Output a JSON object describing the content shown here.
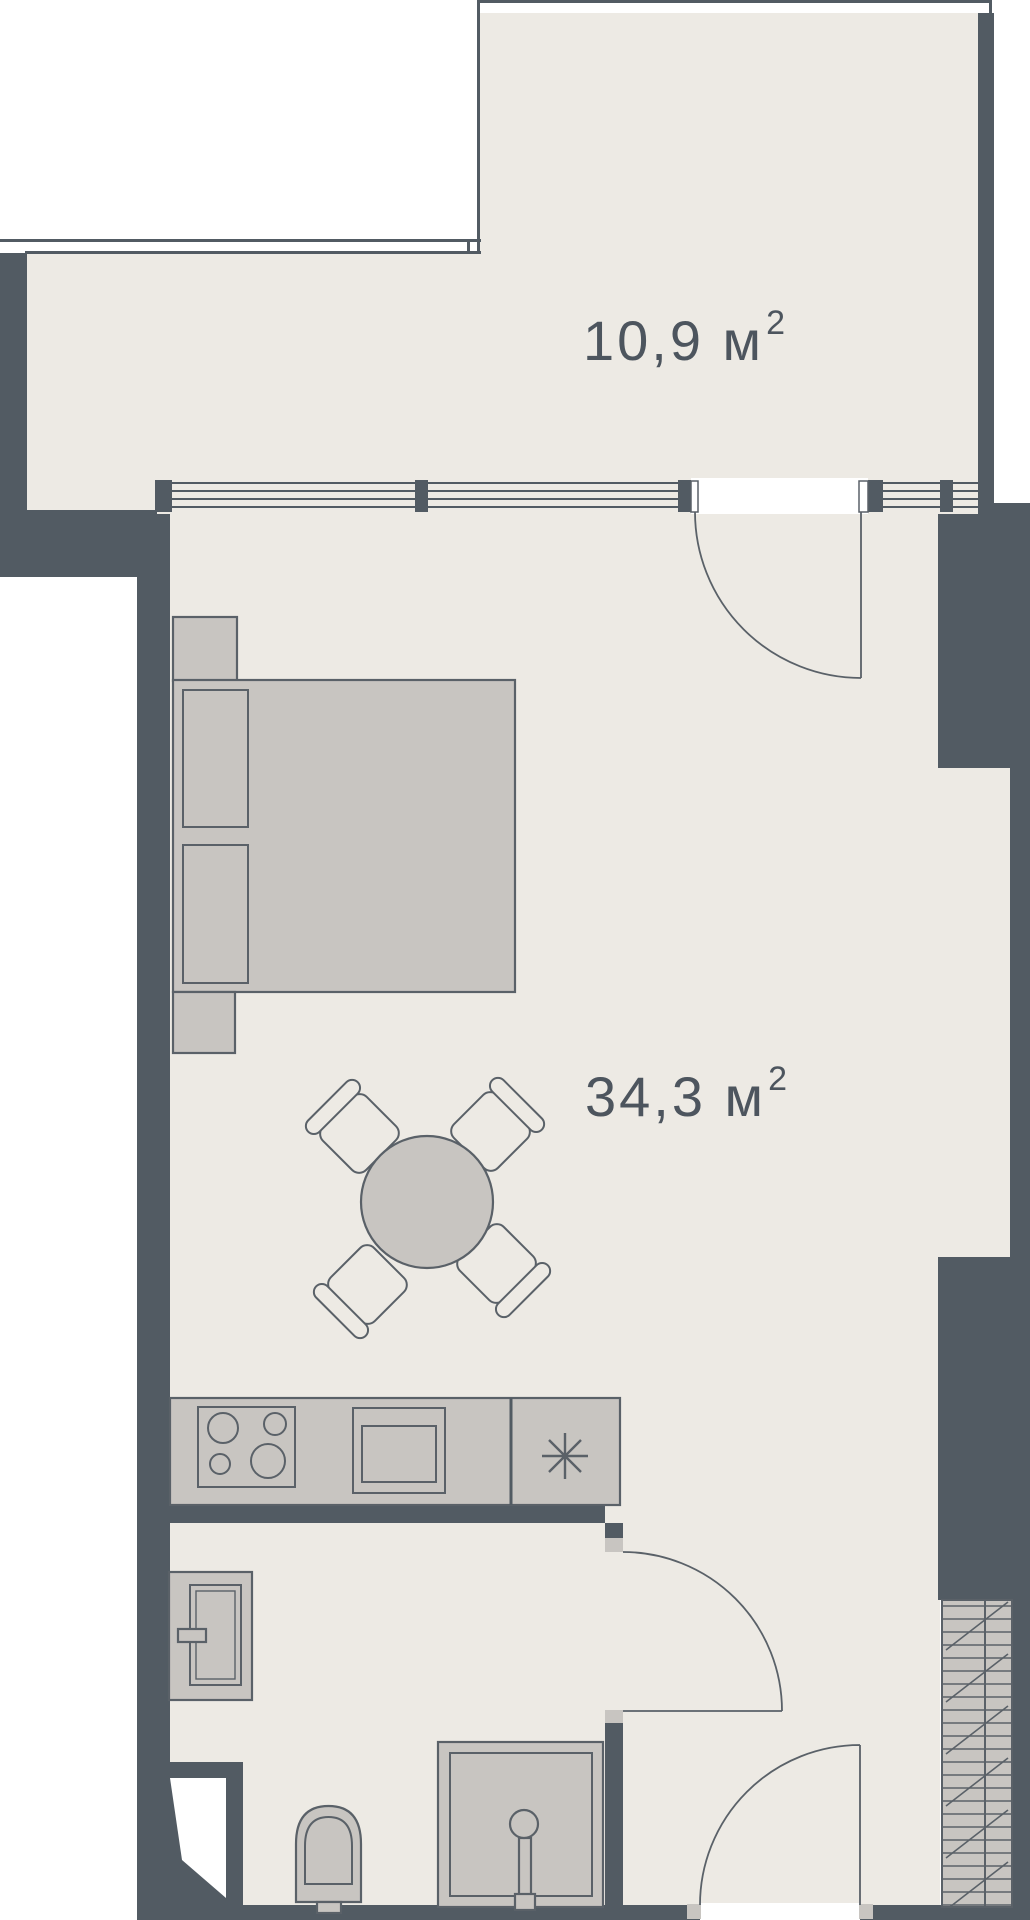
{
  "palette": {
    "wall": "#525b63",
    "floor": "#edeae4",
    "furn": "#c8c5c1",
    "outline": "#5a6168",
    "text": "#4d555e",
    "exterior": "#ffffff"
  },
  "rooms": [
    {
      "id": "terrace",
      "area_value": "10,9 м",
      "area_sup": "2"
    },
    {
      "id": "living-room",
      "area_value": "34,3 м",
      "area_sup": "2"
    }
  ],
  "fixtures": [
    "bed",
    "pillows",
    "nightstands",
    "dining-table",
    "chairs",
    "kitchen-counter",
    "stove-burners",
    "kitchen-sink",
    "fridge-snowflake",
    "washbasin",
    "faucet",
    "toilet",
    "shower-cabin",
    "shower-head",
    "ventilation-shaft",
    "balcony-door",
    "bathroom-door",
    "entry-door",
    "window-band",
    "terrace-railing"
  ]
}
